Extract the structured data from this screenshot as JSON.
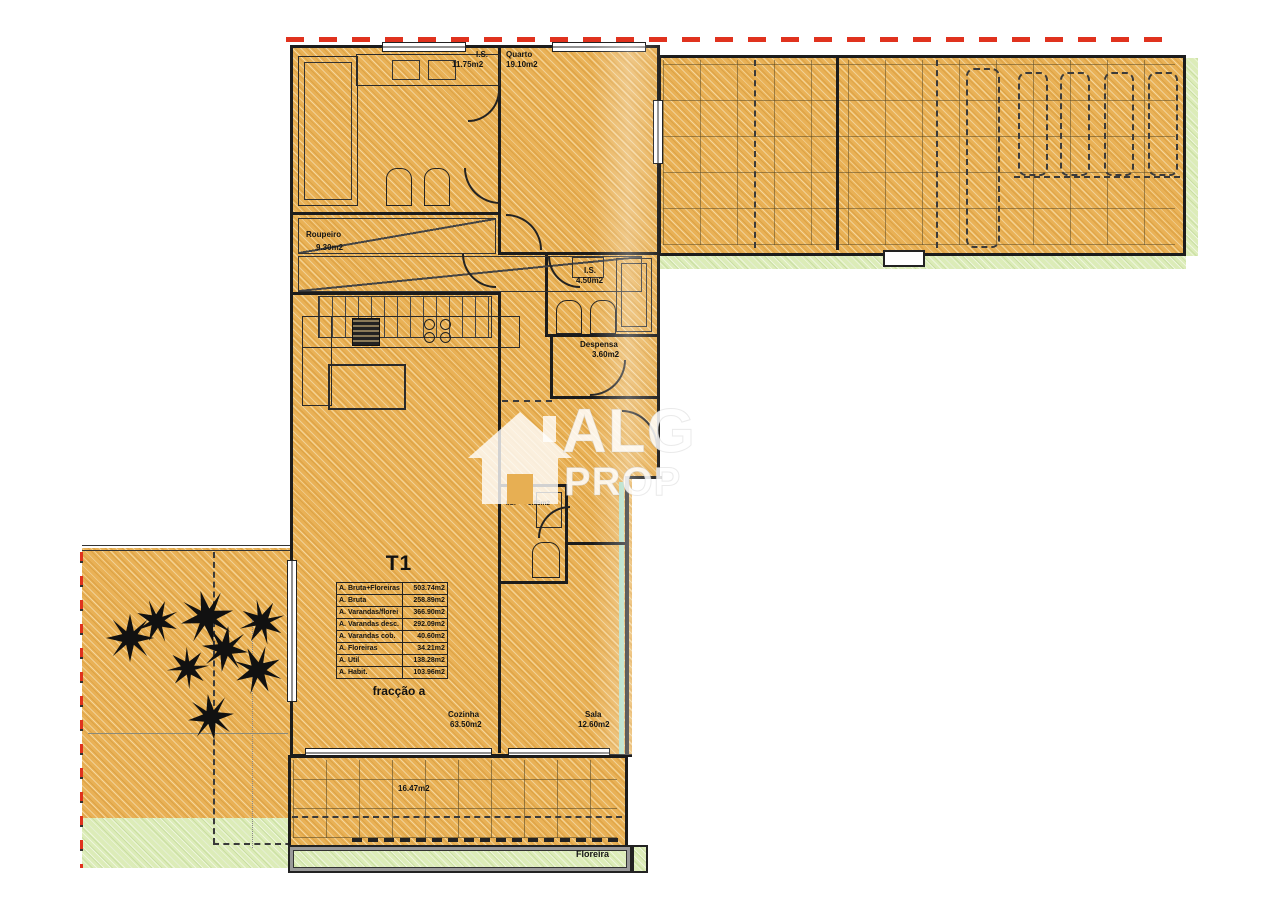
{
  "plan": {
    "watermark": {
      "line1": "ALG",
      "line2": "PROP"
    },
    "unit": {
      "title": "T1",
      "fraction_label": "fracção a",
      "areas": [
        {
          "label": "A. Bruta+Floreiras",
          "value": "503.74m2"
        },
        {
          "label": "A. Bruta",
          "value": "258.89m2"
        },
        {
          "label": "A. Varandas/florei",
          "value": "366.90m2"
        },
        {
          "label": "A. Varandas desc.",
          "value": "292.09m2"
        },
        {
          "label": "A. Varandas cob.",
          "value": "40.60m2"
        },
        {
          "label": "A. Floreiras",
          "value": "34.21m2"
        },
        {
          "label": "A. Util",
          "value": "138.28m2"
        },
        {
          "label": "A. Habit.",
          "value": "103.96m2"
        }
      ]
    },
    "rooms": {
      "is_top": {
        "name": "I.S.",
        "area": "11.75m2"
      },
      "quarto": {
        "name": "Quarto",
        "area": "19.10m2"
      },
      "roupeiro": {
        "name": "Roupeiro",
        "area": "9.30m2"
      },
      "is_mid": {
        "name": "I.S.",
        "area": "4.50m2"
      },
      "despensa": {
        "name": "Despensa",
        "area": "3.60m2"
      },
      "is_small": {
        "name": "I.S.",
        "area": "3.95m2"
      },
      "cozinha": {
        "name": "Cozinha",
        "area": "63.50m2"
      },
      "sala": {
        "name": "Sala",
        "area": "12.60m2"
      },
      "terrace": {
        "area": "16.47m2"
      },
      "floreira": {
        "name": "Floreira"
      }
    },
    "colors": {
      "fill_orange": "#e9b156",
      "fill_green": "#dcecb8",
      "wall": "#1c1c1c",
      "boundary_red": "#e0321e",
      "teal": "#aedcc3",
      "watermark_white": "rgba(255,255,255,0.85)"
    }
  }
}
